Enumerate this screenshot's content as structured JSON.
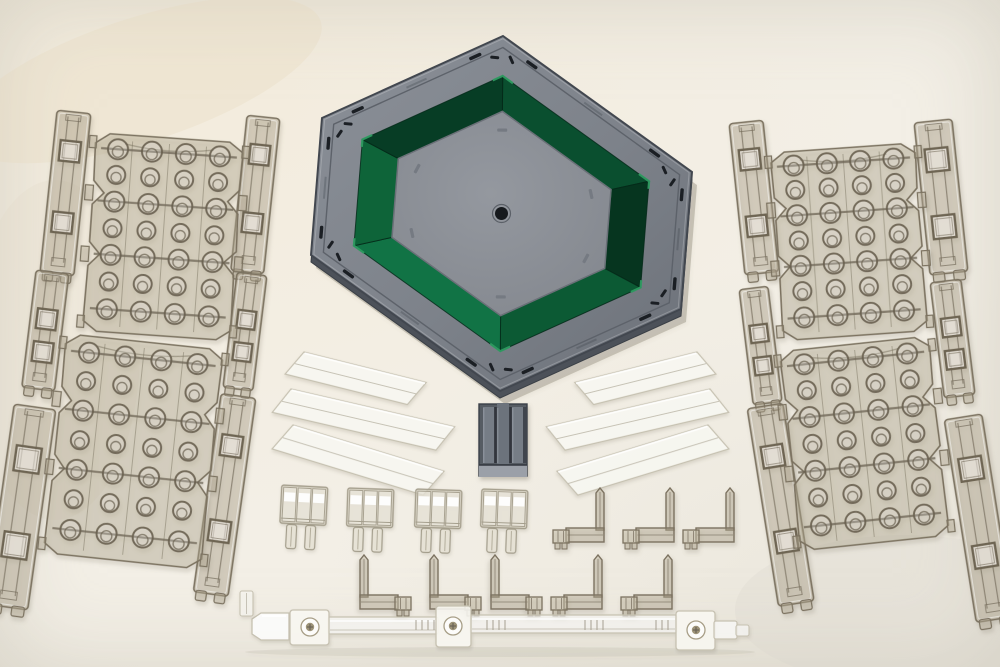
{
  "scene": {
    "kind": "product-photograph",
    "subject": "hexagonal-model-display-base-kit-with-clear-runner-parts",
    "width": 1000,
    "height": 667
  },
  "palette": {
    "bg_base": "#efebe0",
    "smoke_fill": "rgba(183,173,149,0.40)",
    "smoke_fill_bright": "rgba(243,240,232,0.50)",
    "smoke_edge": "#7b7260",
    "smoke_edge_dark": "#6e6553",
    "smoke_highlight": "rgba(255,255,255,0.45)",
    "clear_fill": "rgba(253,252,247,0.78)",
    "clear_edge": "#c6c1b1",
    "clear_fold": "rgba(186,181,166,0.8)",
    "white": "#ffffff",
    "hex_gray_light": "#8b9098",
    "hex_gray_mid": "#7d828a",
    "hex_gray_dark": "#6b7078",
    "hex_bevel": "#4c5159",
    "hex_outline": "#42474f",
    "hex_groove": "#5d626a",
    "slot_black": "#1b1f24",
    "green_corner_hi": "#2f9b61",
    "green_inner_hi": "#1e7c49",
    "green_face_stroke": "rgba(4,40,24,0.8)",
    "center_fill_a": "#94989f",
    "center_fill_b": "#83878e",
    "center_edge": "#6b7078",
    "center_slot": "#757a82",
    "hole_black": "#16191d",
    "hole_ring": "#5b6068",
    "conn_body": "#565c64",
    "conn_rib_light": "#767d86",
    "conn_rib_mid": "#6c737c",
    "conn_gap": "#31363d",
    "conn_base": "#9ba0a8",
    "conn_outline": "#3b4149",
    "screw_metal": "#9d9378",
    "screw_dark": "#6b6456",
    "shadow_flood": "#6e6754"
  },
  "hexagon": {
    "cx": 501.5,
    "cy": 213.5,
    "outer_vertices": [
      [
        503,
        36
      ],
      [
        692,
        172
      ],
      [
        681,
        309
      ],
      [
        500,
        391
      ],
      [
        311,
        255
      ],
      [
        322,
        118
      ]
    ],
    "rim_inner_scale": 0.985,
    "groove_scale": 0.935,
    "green_outer_scale": 0.775,
    "green_inner_scale": 0.575,
    "slot_ring_scale": 0.955,
    "jslot_scale": 0.9,
    "center_slot_scale": 0.47,
    "center_hole_r": 6.5,
    "green_faces": [
      "#0a4f2f",
      "#06351f",
      "#0c5a34",
      "#117345",
      "#0e6439",
      "#073d25"
    ]
  },
  "rails": [
    {
      "id": "rail-left-outer-top",
      "x": 57,
      "y": 112,
      "w": 34,
      "h": 163,
      "rot": 6,
      "holes": [
        0.18,
        0.62
      ]
    },
    {
      "id": "rail-left-outer-mid",
      "x": 36,
      "y": 272,
      "w": 33,
      "h": 118,
      "rot": 7,
      "holes": [
        0.32,
        0.6
      ]
    },
    {
      "id": "rail-left-outer-bottom",
      "x": 14,
      "y": 407,
      "w": 42,
      "h": 202,
      "rot": 8,
      "holes": [
        0.2,
        0.63
      ]
    },
    {
      "id": "rail-left-inner-top",
      "x": 247,
      "y": 117,
      "w": 33,
      "h": 156,
      "rot": 6,
      "holes": [
        0.18,
        0.62
      ]
    },
    {
      "id": "rail-left-inner-mid",
      "x": 237,
      "y": 274,
      "w": 30,
      "h": 116,
      "rot": 7,
      "holes": [
        0.32,
        0.6
      ]
    },
    {
      "id": "rail-left-inner-bottom",
      "x": 221,
      "y": 396,
      "w": 35,
      "h": 200,
      "rot": 8,
      "holes": [
        0.2,
        0.63
      ]
    },
    {
      "id": "rail-right-inner-top",
      "x": 729,
      "y": 122,
      "w": 34,
      "h": 152,
      "rot": -6,
      "holes": [
        0.18,
        0.62
      ]
    },
    {
      "id": "rail-right-inner-mid",
      "x": 739,
      "y": 288,
      "w": 29,
      "h": 116,
      "rot": -7,
      "holes": [
        0.32,
        0.6
      ]
    },
    {
      "id": "rail-right-inner-bottom",
      "x": 747,
      "y": 406,
      "w": 36,
      "h": 200,
      "rot": -9,
      "holes": [
        0.2,
        0.63
      ]
    },
    {
      "id": "rail-right-outer-top",
      "x": 914,
      "y": 121,
      "w": 38,
      "h": 153,
      "rot": -6,
      "holes": [
        0.18,
        0.62
      ]
    },
    {
      "id": "rail-right-outer-mid",
      "x": 930,
      "y": 281,
      "w": 31,
      "h": 116,
      "rot": -7,
      "holes": [
        0.32,
        0.6
      ]
    },
    {
      "id": "rail-right-outer-bottom",
      "x": 944,
      "y": 417,
      "w": 38,
      "h": 205,
      "rot": -9,
      "holes": [
        0.2,
        0.63
      ]
    }
  ],
  "panels": [
    {
      "id": "panel-left-top",
      "x": 96,
      "y": 138,
      "w": 148,
      "h": 198,
      "rot": 4
    },
    {
      "id": "panel-left-bottom",
      "x": 66,
      "y": 342,
      "w": 158,
      "h": 220,
      "rot": 6
    },
    {
      "id": "panel-right-top",
      "x": 770,
      "y": 148,
      "w": 145,
      "h": 188,
      "rot": -4
    },
    {
      "id": "panel-right-bottom",
      "x": 779,
      "y": 344,
      "w": 150,
      "h": 200,
      "rot": -6
    }
  ],
  "panel_grid": {
    "cols": [
      0.155,
      0.385,
      0.615,
      0.845
    ],
    "rows": [
      0.075,
      0.205,
      0.34,
      0.475,
      0.61,
      0.745,
      0.885
    ]
  },
  "blades": {
    "mirror_x": 1001,
    "left": [
      {
        "x": 304,
        "y": 352,
        "len": 126,
        "w": 26,
        "rot": 14
      },
      {
        "x": 291,
        "y": 389,
        "len": 168,
        "w": 27,
        "rot": 13
      },
      {
        "x": 293,
        "y": 425,
        "len": 158,
        "w": 29,
        "rot": 17
      }
    ]
  },
  "connector_block": {
    "x": 479,
    "y": 401,
    "w": 48,
    "h": 78
  },
  "clips": [
    {
      "x": 281,
      "y": 482,
      "rot": 3
    },
    {
      "x": 347,
      "y": 485,
      "rot": 2
    },
    {
      "x": 415,
      "y": 486,
      "rot": 2
    },
    {
      "x": 481,
      "y": 486,
      "rot": 2
    }
  ],
  "brackets": [
    {
      "x": 553,
      "y": 488,
      "mirror": false,
      "row": "upper"
    },
    {
      "x": 623,
      "y": 488,
      "mirror": false,
      "row": "upper"
    },
    {
      "x": 683,
      "y": 488,
      "mirror": false,
      "row": "upper"
    },
    {
      "x": 355,
      "y": 555,
      "mirror": true,
      "row": "lower"
    },
    {
      "x": 425,
      "y": 555,
      "mirror": true,
      "row": "lower"
    },
    {
      "x": 486,
      "y": 555,
      "mirror": true,
      "row": "lower"
    },
    {
      "x": 551,
      "y": 555,
      "mirror": false,
      "row": "lower"
    },
    {
      "x": 621,
      "y": 555,
      "mirror": false,
      "row": "lower"
    }
  ],
  "arm": {
    "cap": {
      "x": 252,
      "y": 613,
      "w": 37,
      "h": 27
    },
    "joints": [
      {
        "x": 290,
        "y": 610,
        "w": 39,
        "h": 35,
        "sx": 310,
        "sy": 627
      },
      {
        "x": 436,
        "y": 606,
        "w": 35,
        "h": 41,
        "sx": 453,
        "sy": 626
      },
      {
        "x": 676,
        "y": 611,
        "w": 39,
        "h": 39,
        "sx": 696,
        "sy": 630
      }
    ],
    "tubes": [
      {
        "x": 328,
        "y": 617,
        "w": 110,
        "h": 17
      },
      {
        "x": 470,
        "y": 615,
        "w": 207,
        "h": 18
      }
    ],
    "end": {
      "x": 714,
      "y": 621,
      "w": 23,
      "h": 18
    },
    "tip": {
      "x": 736,
      "y": 625,
      "w": 13,
      "h": 11
    },
    "ticks": [
      [
        416,
        436
      ],
      [
        487,
        506
      ],
      [
        585,
        604
      ],
      [
        656,
        668
      ]
    ]
  },
  "nub": {
    "x": 240,
    "y": 591,
    "w": 13,
    "h": 25
  }
}
